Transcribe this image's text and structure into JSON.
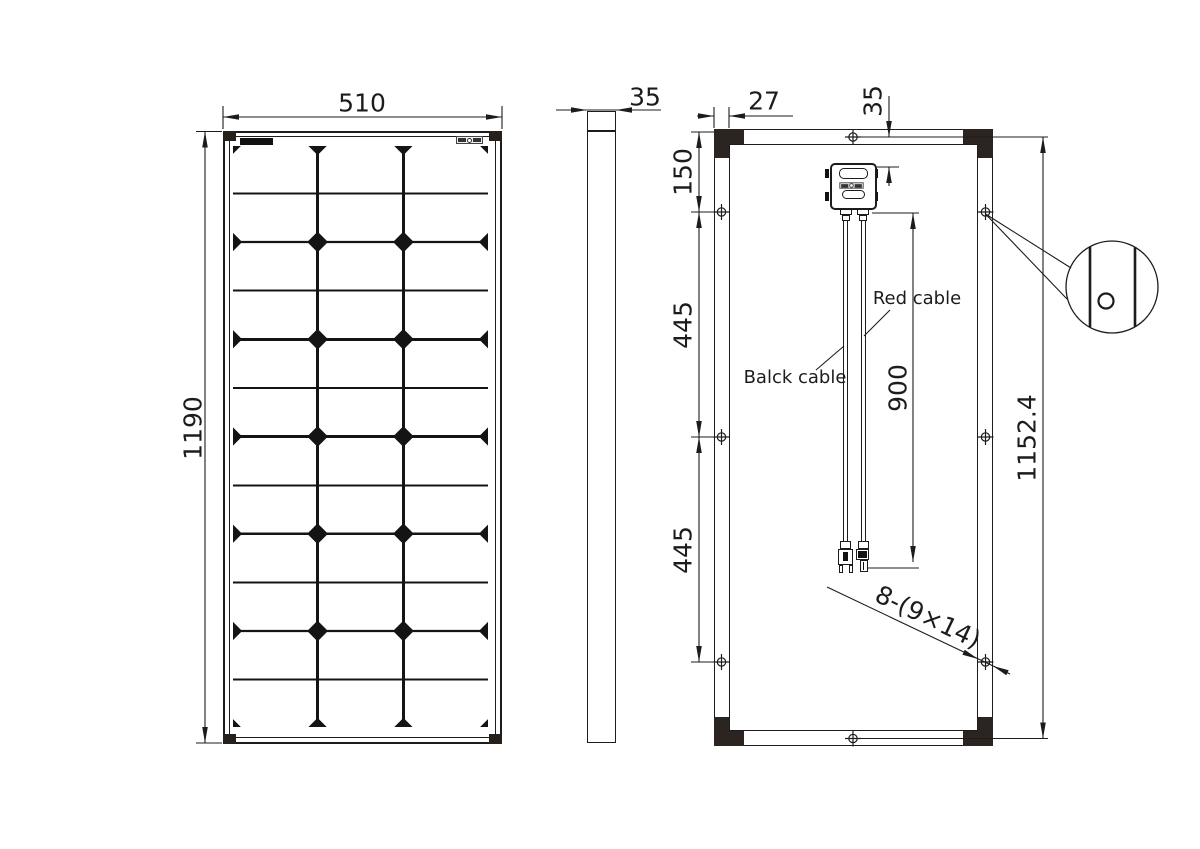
{
  "drawing": {
    "type": "solar-panel-technical-drawing",
    "front_view": {
      "width_label": "510",
      "height_label": "1190",
      "cell_columns": 3,
      "cell_groups": 6
    },
    "side_view": {
      "thickness_label": "35"
    },
    "rear_view": {
      "frame_width_label": "27",
      "box_offset_label": "35",
      "hole_top_offset_label": "150",
      "hole_pitch_label_1": "445",
      "hole_pitch_label_2": "445",
      "cable_length_label": "900",
      "hole_span_label": "1152.4",
      "hole_callout_label": "8-(9×14)",
      "red_cable_label": "Red cable",
      "black_cable_label": "Balck cable"
    }
  }
}
